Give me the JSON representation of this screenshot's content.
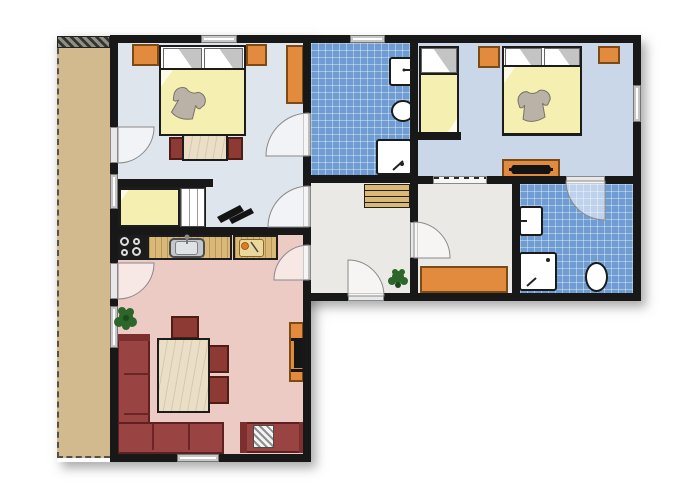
{
  "meta": {
    "description": "apartment-floor-plan",
    "canvas_w": 700,
    "canvas_h": 500
  },
  "palette": {
    "wall": "#181818",
    "balcony": "#d3b98e",
    "bedroom1_floor": "#dfe5ec",
    "bedroom23_floor": "#c9d7e8",
    "bath_tile": "#6f9cd2",
    "hall_floor": "#eae9e5",
    "living_floor": "#edcbc5",
    "furniture_orange": "#e28a3e",
    "wood_counter": "#d9b878",
    "sofa_red": "#9a4343",
    "blanket_yellow": "#f5efb2",
    "plant_green": "#2c662a"
  },
  "rooms": [
    {
      "name": "balcony"
    },
    {
      "name": "bedroom-1"
    },
    {
      "name": "bathroom-1"
    },
    {
      "name": "bedroom-2"
    },
    {
      "name": "hall"
    },
    {
      "name": "storage-room"
    },
    {
      "name": "bathroom-2"
    },
    {
      "name": "living-room-kitchen"
    }
  ],
  "items": [
    {
      "n": "plan-shadow-upper",
      "c": "shadow",
      "x": 57,
      "y": 36,
      "w": 584,
      "h": 265
    },
    {
      "n": "plan-shadow-lower",
      "c": "shadow",
      "x": 57,
      "y": 36,
      "w": 254,
      "h": 426
    },
    {
      "n": "balcony-floor",
      "c": "balcony",
      "x": 57,
      "y": 38,
      "w": 53,
      "h": 420
    },
    {
      "n": "balcony-divider-hatch",
      "c": "hatch",
      "x": 57,
      "y": 36,
      "w": 53,
      "h": 12
    },
    {
      "n": "bedroom1-floor",
      "c": "floor-b1",
      "x": 118,
      "y": 43,
      "w": 186,
      "h": 184
    },
    {
      "n": "bathroom1-floor",
      "c": "tile",
      "x": 311,
      "y": 43,
      "w": 99,
      "h": 132
    },
    {
      "n": "bedroom2-floor",
      "c": "floor-b23",
      "x": 418,
      "y": 43,
      "w": 215,
      "h": 133
    },
    {
      "n": "hall-floor",
      "c": "floor-hall",
      "x": 311,
      "y": 183,
      "w": 99,
      "h": 110
    },
    {
      "n": "storage-floor",
      "c": "floor-hall",
      "x": 418,
      "y": 184,
      "w": 94,
      "h": 109
    },
    {
      "n": "bathroom2-floor",
      "c": "tile",
      "x": 520,
      "y": 184,
      "w": 113,
      "h": 109
    },
    {
      "n": "living-room-floor",
      "c": "floor-living",
      "x": 118,
      "y": 235,
      "w": 185,
      "h": 219
    },
    {
      "n": "bedroom1-wardrobe",
      "c": "orange",
      "x": 132,
      "y": 44,
      "w": 27,
      "h": 22
    },
    {
      "n": "bedroom1-nightstand",
      "c": "orange",
      "x": 246,
      "y": 44,
      "w": 21,
      "h": 22
    },
    {
      "n": "bedroom1-wardrobe-tall",
      "c": "orange",
      "x": 286,
      "y": 45,
      "w": 18,
      "h": 59
    },
    {
      "n": "bedroom1-double-bed",
      "c": "bedbase",
      "x": 159,
      "y": 45,
      "w": 87,
      "h": 91
    },
    {
      "n": "bedroom1-pillow-left",
      "c": "pillow",
      "x": 163,
      "y": 48,
      "w": 39,
      "h": 21
    },
    {
      "n": "bedroom1-pillow-right",
      "c": "pillow",
      "x": 204,
      "y": 48,
      "w": 39,
      "h": 21
    },
    {
      "n": "bedroom1-blanket",
      "c": "blanket",
      "x": 159,
      "y": 68,
      "w": 87,
      "h": 68
    },
    {
      "n": "bedroom1-desk-chair-left",
      "c": "chair",
      "x": 169,
      "y": 137,
      "w": 15,
      "h": 23
    },
    {
      "n": "bedroom1-desk-chair-right",
      "c": "chair",
      "x": 227,
      "y": 137,
      "w": 16,
      "h": 23
    },
    {
      "n": "bedroom1-desk",
      "c": "wood-table",
      "x": 182,
      "y": 134,
      "w": 46,
      "h": 27
    },
    {
      "n": "nook-single-bed",
      "c": "bedbase",
      "x": 118,
      "y": 187,
      "w": 88,
      "h": 41
    },
    {
      "n": "nook-bed-blanket",
      "c": "blanket",
      "x": 119,
      "y": 188,
      "w": 61,
      "h": 39
    },
    {
      "n": "nook-bed-slats",
      "c": "slats",
      "x": 180,
      "y": 188,
      "w": 25,
      "h": 39
    },
    {
      "n": "bedroom2-single-bed",
      "c": "bedbase",
      "x": 419,
      "y": 46,
      "w": 40,
      "h": 89
    },
    {
      "n": "bedroom2-pillow",
      "c": "pillow",
      "x": 421,
      "y": 48,
      "w": 36,
      "h": 25
    },
    {
      "n": "bedroom2-blanket",
      "c": "blanket-b",
      "x": 419,
      "y": 73,
      "w": 40,
      "h": 61
    },
    {
      "n": "bedroom2-nightstand-left",
      "c": "orange",
      "x": 478,
      "y": 46,
      "w": 22,
      "h": 22
    },
    {
      "n": "bedroom2-nightstand-right",
      "c": "orange",
      "x": 598,
      "y": 46,
      "w": 22,
      "h": 18
    },
    {
      "n": "bedroom2-double-bed",
      "c": "bedbase",
      "x": 502,
      "y": 46,
      "w": 80,
      "h": 90
    },
    {
      "n": "bedroom2-pillow-a",
      "c": "pillow",
      "x": 505,
      "y": 48,
      "w": 37,
      "h": 20
    },
    {
      "n": "bedroom2-pillow-b",
      "c": "pillow",
      "x": 544,
      "y": 48,
      "w": 36,
      "h": 20
    },
    {
      "n": "bedroom2-double-blanket",
      "c": "blanket",
      "x": 502,
      "y": 65,
      "w": 80,
      "h": 70
    },
    {
      "n": "bedroom2-dresser",
      "c": "orange",
      "x": 502,
      "y": 159,
      "w": 58,
      "h": 19
    },
    {
      "n": "bathroom1-sink",
      "c": "fixture",
      "x": 389,
      "y": 57,
      "w": 24,
      "h": 29
    },
    {
      "n": "bathroom1-toilet",
      "c": "fixture round",
      "x": 391,
      "y": 100,
      "w": 24,
      "h": 22
    },
    {
      "n": "bathroom1-shower",
      "c": "fixture",
      "x": 376,
      "y": 139,
      "w": 36,
      "h": 36
    },
    {
      "n": "hall-stairs",
      "c": "stairs",
      "x": 364,
      "y": 184,
      "w": 46,
      "h": 24
    },
    {
      "n": "storage-cabinet",
      "c": "orange",
      "x": 420,
      "y": 266,
      "w": 88,
      "h": 27
    },
    {
      "n": "bathroom2-sink",
      "c": "fixture",
      "x": 519,
      "y": 206,
      "w": 24,
      "h": 30
    },
    {
      "n": "bathroom2-shower",
      "c": "fixture",
      "x": 519,
      "y": 252,
      "w": 38,
      "h": 39
    },
    {
      "n": "bathroom2-toilet",
      "c": "fixture round",
      "x": 585,
      "y": 262,
      "w": 23,
      "h": 30
    },
    {
      "n": "kitchen-stove",
      "c": "stove",
      "x": 117,
      "y": 234,
      "w": 30,
      "h": 26
    },
    {
      "n": "stove-burner-1",
      "c": "burner",
      "x": 120,
      "y": 237,
      "w": 9,
      "h": 9
    },
    {
      "n": "stove-burner-2",
      "c": "burner",
      "x": 133,
      "y": 238,
      "w": 7,
      "h": 7
    },
    {
      "n": "stove-burner-3",
      "c": "burner",
      "x": 121,
      "y": 249,
      "w": 7,
      "h": 7
    },
    {
      "n": "stove-burner-4",
      "c": "burner",
      "x": 132,
      "y": 247,
      "w": 9,
      "h": 9
    },
    {
      "n": "kitchen-counter-left",
      "c": "counter",
      "x": 147,
      "y": 235,
      "w": 85,
      "h": 25
    },
    {
      "n": "kitchen-sink",
      "c": "ksink",
      "x": 169,
      "y": 238,
      "w": 36,
      "h": 20
    },
    {
      "n": "kitchen-sink-basin",
      "c": "ksink-basin",
      "x": 175,
      "y": 241,
      "w": 23,
      "h": 14
    },
    {
      "n": "kitchen-counter-right",
      "c": "counter",
      "x": 233,
      "y": 235,
      "w": 45,
      "h": 25
    },
    {
      "n": "cutting-board",
      "c": "board",
      "x": 239,
      "y": 239,
      "w": 25,
      "h": 18
    },
    {
      "n": "sofa-left-section",
      "c": "sofa",
      "x": 117,
      "y": 334,
      "w": 33,
      "h": 120
    },
    {
      "n": "sofa-left-armrest",
      "c": "sofa-dark",
      "x": 117,
      "y": 334,
      "w": 33,
      "h": 7
    },
    {
      "n": "sofa-divider-1",
      "c": "sofa-line",
      "x": 124,
      "y": 373,
      "w": 26,
      "h": 2
    },
    {
      "n": "sofa-divider-2",
      "c": "sofa-line",
      "x": 124,
      "y": 413,
      "w": 26,
      "h": 2
    },
    {
      "n": "sofa-bottom-section",
      "c": "sofa",
      "x": 117,
      "y": 422,
      "w": 107,
      "h": 32
    },
    {
      "n": "sofa-divider-3",
      "c": "sofa-line",
      "x": 152,
      "y": 424,
      "w": 2,
      "h": 26
    },
    {
      "n": "sofa-divider-4",
      "c": "sofa-line",
      "x": 188,
      "y": 424,
      "w": 2,
      "h": 26
    },
    {
      "n": "sofa-right-section",
      "c": "sofa",
      "x": 240,
      "y": 422,
      "w": 66,
      "h": 31
    },
    {
      "n": "sofa-right-armrest-left",
      "c": "sofa-dark",
      "x": 240,
      "y": 422,
      "w": 7,
      "h": 31
    },
    {
      "n": "sofa-right-armrest-right",
      "c": "sofa-dark",
      "x": 299,
      "y": 422,
      "w": 7,
      "h": 31
    },
    {
      "n": "sofa-striped-cushion",
      "c": "striped-pillow",
      "x": 253,
      "y": 425,
      "w": 21,
      "h": 23
    },
    {
      "n": "dining-chair-top",
      "c": "chair",
      "x": 171,
      "y": 316,
      "w": 28,
      "h": 23
    },
    {
      "n": "dining-chair-right-1",
      "c": "chair",
      "x": 206,
      "y": 345,
      "w": 23,
      "h": 28
    },
    {
      "n": "dining-chair-right-2",
      "c": "chair",
      "x": 206,
      "y": 376,
      "w": 23,
      "h": 28
    },
    {
      "n": "dining-table",
      "c": "wood-table",
      "x": 157,
      "y": 338,
      "w": 53,
      "h": 75
    },
    {
      "n": "tv-sideboard",
      "c": "orange",
      "x": 289,
      "y": 322,
      "w": 15,
      "h": 60
    },
    {
      "n": "tv-shelf-top",
      "c": "dark",
      "x": 291,
      "y": 338,
      "w": 13,
      "h": 3
    },
    {
      "n": "living-tv",
      "c": "dark",
      "x": 294,
      "y": 341,
      "w": 10,
      "h": 27
    },
    {
      "n": "tv-shelf-bottom",
      "c": "dark",
      "x": 291,
      "y": 369,
      "w": 13,
      "h": 3
    },
    {
      "n": "wall-top",
      "c": "wall",
      "x": 110,
      "y": 35,
      "w": 531,
      "h": 8
    },
    {
      "n": "wall-left",
      "c": "wall",
      "x": 110,
      "y": 35,
      "w": 8,
      "h": 427
    },
    {
      "n": "wall-right",
      "c": "wall",
      "x": 633,
      "y": 35,
      "w": 8,
      "h": 266
    },
    {
      "n": "wall-bottom-right",
      "c": "wall",
      "x": 303,
      "y": 293,
      "w": 338,
      "h": 8
    },
    {
      "n": "wall-bottom-left",
      "c": "wall",
      "x": 110,
      "y": 454,
      "w": 201,
      "h": 8
    },
    {
      "n": "wall-v1-upper",
      "c": "wall",
      "x": 303,
      "y": 35,
      "w": 8,
      "h": 258
    },
    {
      "n": "wall-v1-lower",
      "c": "wall",
      "x": 303,
      "y": 293,
      "w": 8,
      "h": 169
    },
    {
      "n": "wall-nook-stub",
      "c": "wall",
      "x": 110,
      "y": 179,
      "w": 103,
      "h": 8
    },
    {
      "n": "wall-living-divider",
      "c": "wall",
      "x": 110,
      "y": 227,
      "w": 201,
      "h": 8
    },
    {
      "n": "wall-bathroom1-bottom",
      "c": "wall",
      "x": 303,
      "y": 175,
      "w": 115,
      "h": 8
    },
    {
      "n": "wall-v2",
      "c": "wall",
      "x": 410,
      "y": 35,
      "w": 8,
      "h": 266
    },
    {
      "n": "wall-h4",
      "c": "wall",
      "x": 410,
      "y": 176,
      "w": 231,
      "h": 8
    },
    {
      "n": "wall-v3",
      "c": "wall",
      "x": 512,
      "y": 176,
      "w": 8,
      "h": 125
    },
    {
      "n": "wall-bed2-stub",
      "c": "wall",
      "x": 415,
      "y": 132,
      "w": 46,
      "h": 8
    },
    {
      "n": "window-bedroom1-top",
      "c": "window",
      "x": 201,
      "y": 35,
      "w": 36,
      "h": 8
    },
    {
      "n": "window-bathroom1-top",
      "c": "window",
      "x": 350,
      "y": 35,
      "w": 35,
      "h": 8
    },
    {
      "n": "window-bedroom2-right",
      "c": "window",
      "x": 633,
      "y": 85,
      "w": 8,
      "h": 37
    },
    {
      "n": "window-nook-left",
      "c": "window",
      "x": 110,
      "y": 174,
      "w": 8,
      "h": 35
    },
    {
      "n": "window-living-left",
      "c": "window",
      "x": 110,
      "y": 306,
      "w": 8,
      "h": 42
    },
    {
      "n": "window-living-bottom",
      "c": "window",
      "x": 177,
      "y": 454,
      "w": 42,
      "h": 8
    },
    {
      "n": "sliding-door-bedroom2",
      "c": "slider",
      "x": 433,
      "y": 176,
      "w": 54,
      "h": 8
    },
    {
      "n": "door-leaf-balcony-bedroom1",
      "c": "leaf",
      "x": 110,
      "y": 127,
      "w": 8,
      "h": 36
    },
    {
      "n": "door-leaf-balcony-living",
      "c": "leaf",
      "x": 110,
      "y": 263,
      "w": 8,
      "h": 36
    },
    {
      "n": "door-leaf-bathroom1",
      "c": "leaf",
      "x": 303,
      "y": 113,
      "w": 8,
      "h": 43
    },
    {
      "n": "door-leaf-bedroom1",
      "c": "leaf",
      "x": 303,
      "y": 186,
      "w": 8,
      "h": 41
    },
    {
      "n": "door-leaf-living",
      "c": "leaf",
      "x": 303,
      "y": 245,
      "w": 8,
      "h": 35
    },
    {
      "n": "door-leaf-storage",
      "c": "leaf",
      "x": 410,
      "y": 222,
      "w": 8,
      "h": 36
    },
    {
      "n": "door-leaf-entry",
      "c": "leaf",
      "x": 348,
      "y": 293,
      "w": 36,
      "h": 8
    },
    {
      "n": "door-leaf-bathroom2",
      "c": "leaf",
      "x": 566,
      "y": 176,
      "w": 39,
      "h": 8
    }
  ],
  "svg": [
    {
      "n": "door-arc-balcony-bedroom1",
      "t": "path",
      "d": "M118,127 L118,163 A36,36 0 0 0 154,127 Z",
      "f": "rgba(255,255,255,0.55)",
      "s": "#8a8a8a",
      "sw": 1
    },
    {
      "n": "door-arc-balcony-living",
      "t": "path",
      "d": "M118,263 L118,299 A36,36 0 0 0 154,263 Z",
      "f": "rgba(255,255,255,0.55)",
      "s": "#8a8a8a",
      "sw": 1
    },
    {
      "n": "door-arc-bathroom1",
      "t": "path",
      "d": "M309,156 L309,113 A43,43 0 0 0 266,156 Z",
      "f": "rgba(255,255,255,0.55)",
      "s": "#8a8a8a",
      "sw": 1
    },
    {
      "n": "door-arc-bedroom1",
      "t": "path",
      "d": "M309,227 L309,186 A41,41 0 0 0 268,227 Z",
      "f": "rgba(255,255,255,0.55)",
      "s": "#8a8a8a",
      "sw": 1
    },
    {
      "n": "door-arc-living",
      "t": "path",
      "d": "M309,280 L309,245 A35,35 0 0 0 274,280 Z",
      "f": "rgba(255,255,255,0.55)",
      "s": "#8a8a8a",
      "sw": 1
    },
    {
      "n": "door-arc-storage",
      "t": "path",
      "d": "M414,258 L414,222 A36,36 0 0 1 450,258 Z",
      "f": "rgba(255,255,255,0.55)",
      "s": "#8a8a8a",
      "sw": 1
    },
    {
      "n": "door-arc-entry",
      "t": "path",
      "d": "M348,296 L384,296 A36,36 0 0 0 348,260 Z",
      "f": "rgba(255,255,255,0.55)",
      "s": "#8a8a8a",
      "sw": 1
    },
    {
      "n": "door-arc-bathroom2",
      "t": "path",
      "d": "M605,181 L566,181 A39,39 0 0 0 605,220 Z",
      "f": "rgba(255,255,255,0.55)",
      "s": "#8a8a8a",
      "sw": 1
    },
    {
      "n": "sweater-bedroom1",
      "t": "path",
      "tr": "translate(176,82) rotate(18)",
      "d": "M2,13 C1,6 7,2 12,3 C15,6 21,6 24,3 C29,2 35,6 34,13 L31,18 C29,19 27,18 26,16 L27,30 C19,34 11,34 5,30 L8,16 C7,18 5,19 3,18 Z",
      "f": "#bab2a7",
      "s": "#7a7265",
      "sw": 1
    },
    {
      "n": "sweater-bedroom2",
      "t": "path",
      "tr": "translate(515,90) rotate(-6)",
      "d": "M2,13 C1,6 7,2 12,3 C15,6 21,6 24,3 C29,2 35,6 34,13 L31,18 C29,19 27,18 26,16 L27,30 C19,34 11,34 5,30 L8,16 C7,18 5,19 3,18 Z",
      "f": "#bab2a7",
      "s": "#7a7265",
      "sw": 1
    },
    {
      "n": "nook-black-object-bar1",
      "t": "path",
      "d": "M217,217 L240,205 L244,211 L221,223 Z",
      "f": "#141414"
    },
    {
      "n": "nook-black-object-bar2",
      "t": "path",
      "d": "M229,219 L251,208 L254,213 L232,224 Z",
      "f": "#141414"
    },
    {
      "n": "dresser-tv",
      "t": "path",
      "d": "M513,165 L549,165 Q553,169.5 549,174 L513,174 Q509,169.5 513,165 Z",
      "f": "#141414"
    },
    {
      "n": "dresser-tv-bar",
      "t": "path",
      "d": "M509,168 L553,168 L553,171 L509,171 Z",
      "f": "#141414"
    },
    {
      "n": "plant-living-leaf-1",
      "t": "circle",
      "cx": 126,
      "cy": 317,
      "r": 7,
      "f": "#2c662a"
    },
    {
      "n": "plant-living-leaf-2",
      "t": "circle",
      "cx": 119,
      "cy": 322,
      "r": 5,
      "f": "#2c662a"
    },
    {
      "n": "plant-living-leaf-3",
      "t": "circle",
      "cx": 132,
      "cy": 322,
      "r": 5,
      "f": "#2c662a"
    },
    {
      "n": "plant-living-leaf-4",
      "t": "circle",
      "cx": 122,
      "cy": 311,
      "r": 4,
      "f": "#2c662a"
    },
    {
      "n": "plant-living-leaf-5",
      "t": "circle",
      "cx": 130,
      "cy": 312,
      "r": 4,
      "f": "#2c662a"
    },
    {
      "n": "plant-living-leaf-6",
      "t": "circle",
      "cx": 126,
      "cy": 326,
      "r": 4,
      "f": "#2c662a"
    },
    {
      "n": "plant-living-center",
      "t": "circle",
      "cx": 126,
      "cy": 318,
      "r": 3,
      "f": "#1c4a1b"
    },
    {
      "n": "plant-hall-leaf-1",
      "t": "circle",
      "cx": 398,
      "cy": 277,
      "r": 6,
      "f": "#2c662a"
    },
    {
      "n": "plant-hall-leaf-2",
      "t": "circle",
      "cx": 392,
      "cy": 281,
      "r": 4,
      "f": "#2c662a"
    },
    {
      "n": "plant-hall-leaf-3",
      "t": "circle",
      "cx": 404,
      "cy": 281,
      "r": 4,
      "f": "#2c662a"
    },
    {
      "n": "plant-hall-leaf-4",
      "t": "circle",
      "cx": 395,
      "cy": 272,
      "r": 3,
      "f": "#2c662a"
    },
    {
      "n": "plant-hall-leaf-5",
      "t": "circle",
      "cx": 402,
      "cy": 272,
      "r": 3,
      "f": "#2c662a"
    },
    {
      "n": "plant-hall-center",
      "t": "circle",
      "cx": 398,
      "cy": 285,
      "r": 3,
      "f": "#1c4a1b"
    },
    {
      "n": "cutting-board-knife",
      "t": "line",
      "x1": 251,
      "y1": 242,
      "x2": 258,
      "y2": 252,
      "s": "#444444",
      "sw": 1.5
    },
    {
      "n": "cutting-board-food",
      "t": "circle",
      "cx": 245,
      "cy": 246,
      "r": 3.5,
      "f": "#df7d22",
      "s": "#8a4a10",
      "sw": 0.8
    },
    {
      "n": "kitchen-faucet",
      "t": "line",
      "x1": 187,
      "y1": 237,
      "x2": 187,
      "y2": 244,
      "s": "#777777",
      "sw": 2
    },
    {
      "n": "kitchen-faucet-head",
      "t": "circle",
      "cx": 187,
      "cy": 237,
      "r": 2.5,
      "f": "#8a8a8a"
    },
    {
      "n": "bathroom1-faucet",
      "t": "line",
      "x1": 405,
      "y1": 70,
      "x2": 412,
      "y2": 70,
      "s": "#222222",
      "sw": 2
    },
    {
      "n": "bathroom1-faucet-dot",
      "t": "circle",
      "cx": 404,
      "cy": 70,
      "r": 1.5,
      "f": "#222222"
    },
    {
      "n": "bathroom1-shower-drain",
      "t": "circle",
      "cx": 402,
      "cy": 164,
      "r": 2,
      "f": "#222222"
    },
    {
      "n": "bathroom1-shower-handle",
      "t": "line",
      "x1": 393,
      "y1": 170,
      "x2": 403,
      "y2": 161,
      "s": "#222222",
      "sw": 2
    },
    {
      "n": "bathroom2-faucet",
      "t": "line",
      "x1": 520,
      "y1": 221,
      "x2": 527,
      "y2": 221,
      "s": "#222222",
      "sw": 2
    },
    {
      "n": "bathroom2-shower-drain",
      "t": "circle",
      "cx": 548,
      "cy": 260,
      "r": 2,
      "f": "#222222"
    },
    {
      "n": "bathroom2-shower-handle",
      "t": "line",
      "x1": 527,
      "y1": 286,
      "x2": 536,
      "y2": 278,
      "s": "#222222",
      "sw": 2
    }
  ]
}
